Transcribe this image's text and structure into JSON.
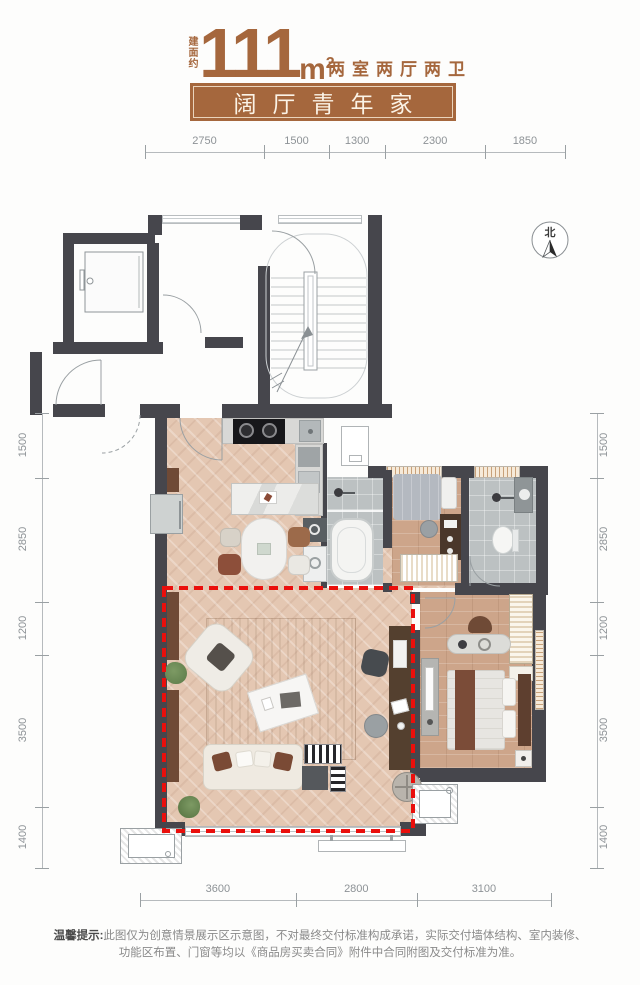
{
  "header": {
    "area_label": "建面约",
    "area_value": "111",
    "area_unit_base": "m",
    "area_unit_sup": "2",
    "rooms_text": "两室两厅两卫",
    "banner_title": "阔厅青年家"
  },
  "north_indicator": {
    "label": "北"
  },
  "dimensions": {
    "top": [
      "2750",
      "1500",
      "1300",
      "2300",
      "1850"
    ],
    "left": [
      "1500",
      "2850",
      "1200",
      "3500",
      "1400"
    ],
    "right": [
      "1500",
      "2850",
      "1200",
      "3500",
      "1400"
    ],
    "bottom": [
      "3600",
      "2800",
      "3100"
    ]
  },
  "disclaimer": {
    "prefix": "温馨提示:",
    "text1": "此图仅为创意情景展示区示意图，不对最终交付标准构成承诺，实际交付墙体结构、室内装修、",
    "text2": "功能区布置、门窗等均以《商品房买卖合同》附件中合同附图及交付标准为准。"
  },
  "colors": {
    "brand_brown": "#a5673d",
    "wall_dark": "#46464c",
    "highlight_red": "#ea0f0c"
  }
}
